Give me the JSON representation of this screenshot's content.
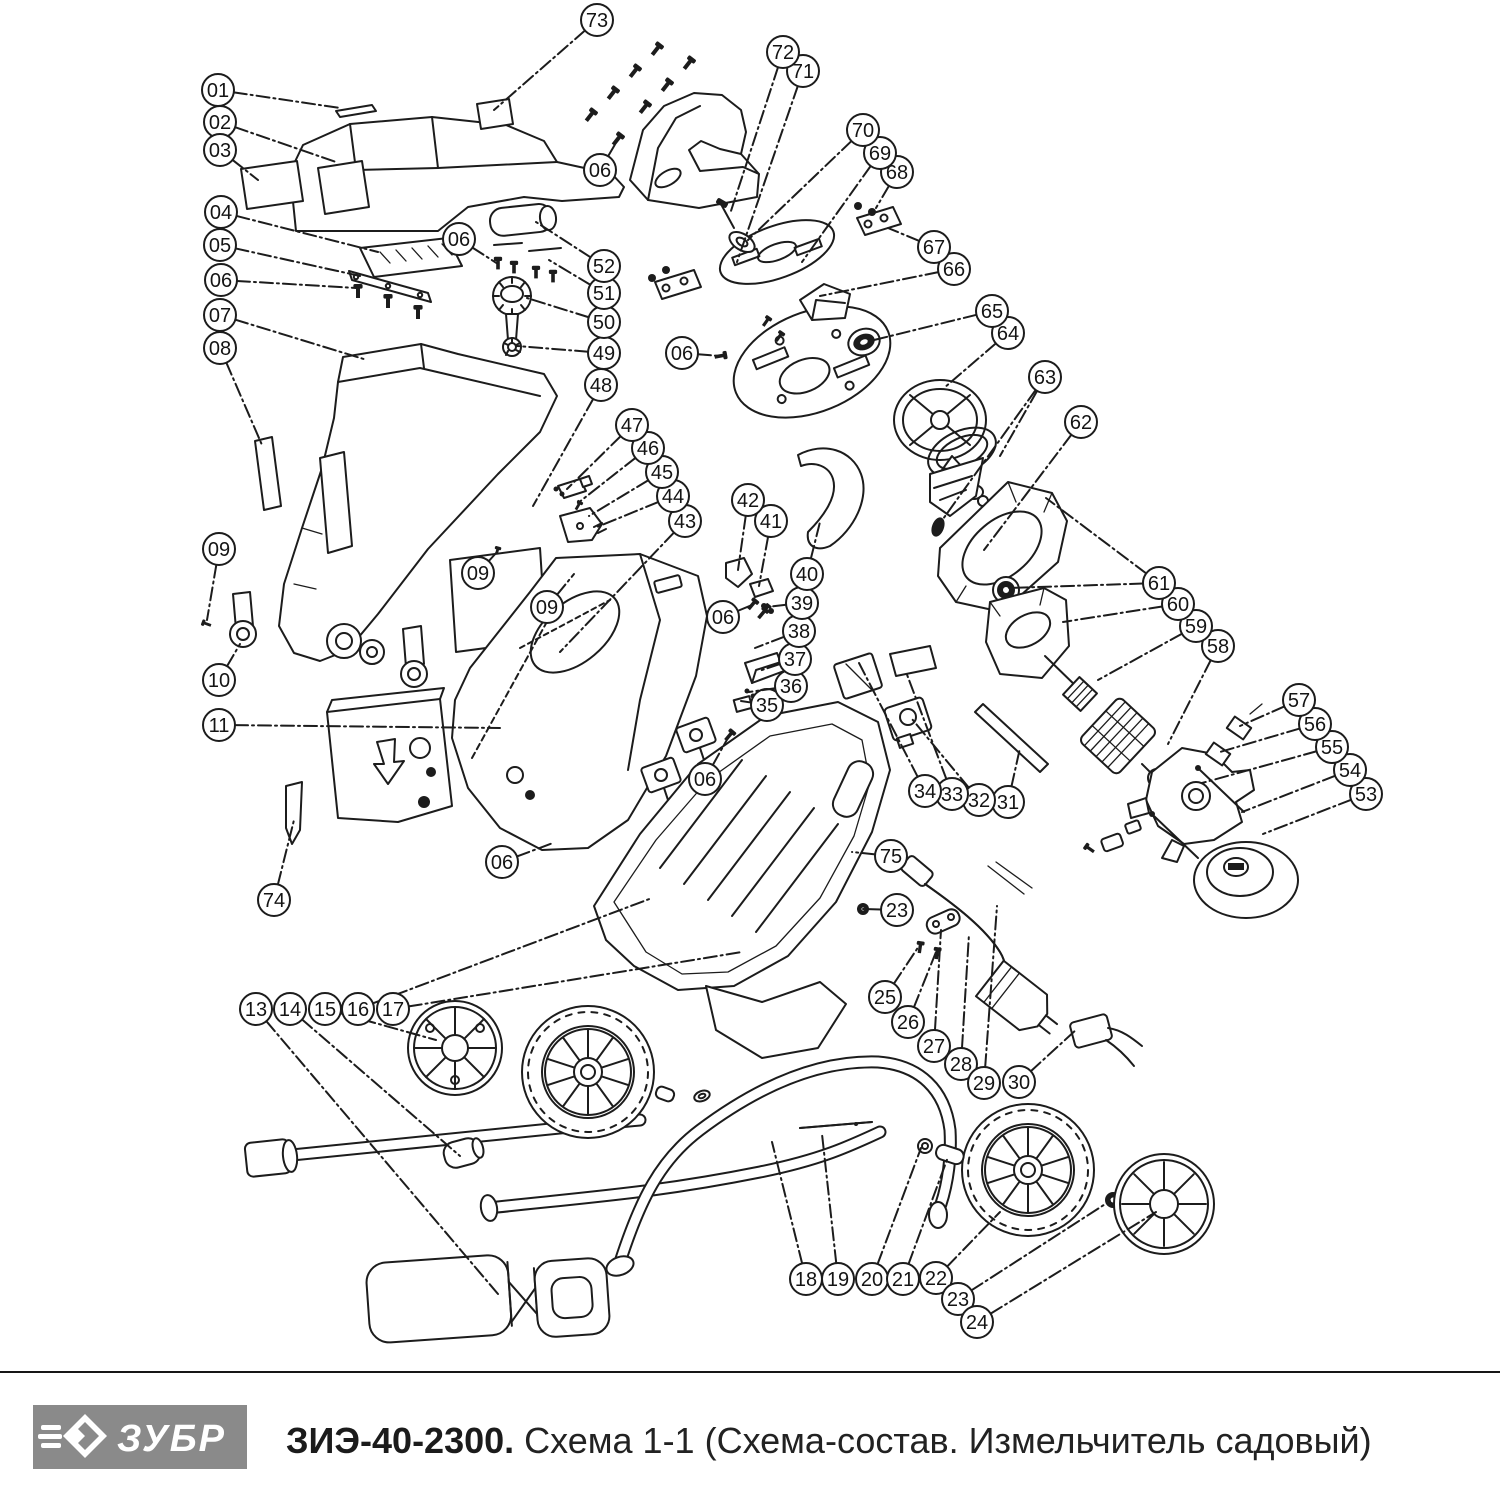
{
  "footer": {
    "brand": "ЗУБР",
    "model": "ЗИЭ-40-2300.",
    "subtitle": " Схема 1-1 (Схема-состав. Измельчитель садовый)",
    "logo_bg": "#8a8a8a",
    "logo_text_color": "#ffffff"
  },
  "diagram": {
    "line_color": "#1c1c1c",
    "callout_radius": 16,
    "callouts": [
      {
        "label": "01",
        "x": 218,
        "y": 90,
        "leaders": [
          [
            340,
            108
          ]
        ]
      },
      {
        "label": "02",
        "x": 220,
        "y": 122,
        "leaders": [
          [
            336,
            162
          ]
        ]
      },
      {
        "label": "03",
        "x": 220,
        "y": 150,
        "leaders": [
          [
            258,
            180
          ]
        ]
      },
      {
        "label": "04",
        "x": 221,
        "y": 212,
        "leaders": [
          [
            378,
            252
          ]
        ]
      },
      {
        "label": "05",
        "x": 220,
        "y": 245,
        "leaders": [
          [
            360,
            276
          ]
        ]
      },
      {
        "label": "06",
        "x": 221,
        "y": 280,
        "leaders": [
          [
            356,
            288
          ]
        ]
      },
      {
        "label": "07",
        "x": 220,
        "y": 315,
        "leaders": [
          [
            367,
            360
          ]
        ]
      },
      {
        "label": "08",
        "x": 220,
        "y": 348,
        "leaders": [
          [
            262,
            445
          ]
        ]
      },
      {
        "label": "09",
        "x": 219,
        "y": 549,
        "leaders": [
          [
            207,
            620
          ]
        ]
      },
      {
        "label": "10",
        "x": 219,
        "y": 680,
        "leaders": [
          [
            240,
            644
          ]
        ]
      },
      {
        "label": "11",
        "x": 219,
        "y": 725,
        "leaders": [
          [
            500,
            728
          ]
        ]
      },
      {
        "label": "74",
        "x": 274,
        "y": 900,
        "leaders": [
          [
            294,
            820
          ]
        ]
      },
      {
        "label": "13",
        "x": 256,
        "y": 1009,
        "leaders": [
          [
            498,
            1294
          ]
        ]
      },
      {
        "label": "14",
        "x": 290,
        "y": 1009,
        "leaders": [
          [
            460,
            1156
          ]
        ]
      },
      {
        "label": "15",
        "x": 325,
        "y": 1009,
        "leaders": [
          [
            436,
            1040
          ]
        ]
      },
      {
        "label": "16",
        "x": 358,
        "y": 1009,
        "leaders": [
          [
            652,
            898
          ]
        ]
      },
      {
        "label": "17",
        "x": 393,
        "y": 1009,
        "leaders": [
          [
            742,
            952
          ]
        ]
      },
      {
        "label": "18",
        "x": 806,
        "y": 1279,
        "leaders": [
          [
            772,
            1142
          ]
        ]
      },
      {
        "label": "19",
        "x": 838,
        "y": 1279,
        "leaders": [
          [
            822,
            1134
          ]
        ]
      },
      {
        "label": "20",
        "x": 872,
        "y": 1279,
        "leaders": [
          [
            921,
            1148
          ]
        ]
      },
      {
        "label": "21",
        "x": 903,
        "y": 1279,
        "leaders": [
          [
            948,
            1157
          ]
        ]
      },
      {
        "label": "22",
        "x": 936,
        "y": 1278,
        "leaders": [
          [
            1000,
            1212
          ]
        ]
      },
      {
        "label": "23",
        "x": 958,
        "y": 1299,
        "leaders": [
          [
            1110,
            1201
          ]
        ]
      },
      {
        "label": "24",
        "x": 977,
        "y": 1322,
        "leaders": [
          [
            1156,
            1212
          ]
        ]
      },
      {
        "label": "25",
        "x": 885,
        "y": 997,
        "leaders": [
          [
            919,
            946
          ]
        ]
      },
      {
        "label": "26",
        "x": 908,
        "y": 1022,
        "leaders": [
          [
            936,
            952
          ]
        ]
      },
      {
        "label": "27",
        "x": 934,
        "y": 1046,
        "leaders": [
          [
            941,
            930
          ]
        ]
      },
      {
        "label": "28",
        "x": 961,
        "y": 1064,
        "leaders": [
          [
            969,
            934
          ]
        ]
      },
      {
        "label": "29",
        "x": 984,
        "y": 1083,
        "leaders": [
          [
            997,
            906
          ]
        ]
      },
      {
        "label": "30",
        "x": 1019,
        "y": 1082,
        "leaders": [
          [
            1077,
            1029
          ]
        ]
      },
      {
        "label": "31",
        "x": 1008,
        "y": 802,
        "leaders": [
          [
            1020,
            748
          ]
        ]
      },
      {
        "label": "32",
        "x": 979,
        "y": 800,
        "leaders": [
          [
            912,
            719
          ]
        ]
      },
      {
        "label": "33",
        "x": 952,
        "y": 794,
        "leaders": [
          [
            906,
            672
          ]
        ]
      },
      {
        "label": "34",
        "x": 925,
        "y": 791,
        "leaders": [
          [
            859,
            663
          ]
        ]
      },
      {
        "label": "35",
        "x": 767,
        "y": 705,
        "leaders": [
          [
            741,
            701
          ]
        ]
      },
      {
        "label": "36",
        "x": 791,
        "y": 686,
        "leaders": [
          [
            749,
            692
          ]
        ]
      },
      {
        "label": "37",
        "x": 795,
        "y": 659,
        "leaders": [
          [
            759,
            671
          ]
        ]
      },
      {
        "label": "38",
        "x": 799,
        "y": 631,
        "leaders": [
          [
            755,
            648
          ]
        ]
      },
      {
        "label": "39",
        "x": 802,
        "y": 603,
        "leaders": [
          [
            766,
            607
          ]
        ]
      },
      {
        "label": "40",
        "x": 807,
        "y": 574,
        "leaders": [
          [
            820,
            522
          ]
        ]
      },
      {
        "label": "41",
        "x": 771,
        "y": 521,
        "leaders": [
          [
            759,
            586
          ]
        ]
      },
      {
        "label": "42",
        "x": 748,
        "y": 500,
        "leaders": [
          [
            738,
            570
          ]
        ]
      },
      {
        "label": "43",
        "x": 685,
        "y": 521,
        "leaders": [
          [
            560,
            652
          ]
        ]
      },
      {
        "label": "44",
        "x": 673,
        "y": 496,
        "leaders": [
          [
            597,
            527
          ]
        ]
      },
      {
        "label": "45",
        "x": 662,
        "y": 472,
        "leaders": [
          [
            589,
            516
          ]
        ]
      },
      {
        "label": "46",
        "x": 648,
        "y": 448,
        "leaders": [
          [
            578,
            503
          ]
        ]
      },
      {
        "label": "47",
        "x": 632,
        "y": 425,
        "leaders": [
          [
            567,
            489
          ]
        ]
      },
      {
        "label": "48",
        "x": 601,
        "y": 385,
        "leaders": [
          [
            533,
            506
          ]
        ]
      },
      {
        "label": "49",
        "x": 604,
        "y": 353,
        "leaders": [
          [
            517,
            346
          ]
        ]
      },
      {
        "label": "50",
        "x": 604,
        "y": 322,
        "leaders": [
          [
            527,
            298
          ]
        ]
      },
      {
        "label": "51",
        "x": 604,
        "y": 293,
        "leaders": [
          [
            549,
            260
          ]
        ]
      },
      {
        "label": "52",
        "x": 604,
        "y": 266,
        "leaders": [
          [
            536,
            222
          ]
        ]
      },
      {
        "label": "53",
        "x": 1366,
        "y": 794,
        "leaders": [
          [
            1263,
            834
          ]
        ]
      },
      {
        "label": "54",
        "x": 1350,
        "y": 770,
        "leaders": [
          [
            1242,
            812
          ]
        ]
      },
      {
        "label": "55",
        "x": 1332,
        "y": 747,
        "leaders": [
          [
            1202,
            783
          ]
        ]
      },
      {
        "label": "56",
        "x": 1315,
        "y": 724,
        "leaders": [
          [
            1220,
            752
          ]
        ]
      },
      {
        "label": "57",
        "x": 1299,
        "y": 700,
        "leaders": [
          [
            1240,
            726
          ]
        ]
      },
      {
        "label": "58",
        "x": 1218,
        "y": 646,
        "leaders": [
          [
            1168,
            744
          ]
        ]
      },
      {
        "label": "59",
        "x": 1196,
        "y": 626,
        "leaders": [
          [
            1098,
            680
          ]
        ]
      },
      {
        "label": "60",
        "x": 1178,
        "y": 604,
        "leaders": [
          [
            1063,
            622
          ]
        ]
      },
      {
        "label": "61",
        "x": 1159,
        "y": 583,
        "leaders": [
          [
            1046,
            498
          ],
          [
            1008,
            588
          ]
        ]
      },
      {
        "label": "62",
        "x": 1081,
        "y": 422,
        "leaders": [
          [
            984,
            550
          ]
        ]
      },
      {
        "label": "63",
        "x": 1045,
        "y": 377,
        "leaders": [
          [
            1000,
            456
          ],
          [
            938,
            526
          ]
        ]
      },
      {
        "label": "64",
        "x": 1008,
        "y": 333,
        "leaders": [
          [
            944,
            388
          ]
        ]
      },
      {
        "label": "65",
        "x": 992,
        "y": 311,
        "leaders": [
          [
            866,
            342
          ]
        ]
      },
      {
        "label": "66",
        "x": 954,
        "y": 269,
        "leaders": [
          [
            820,
            296
          ]
        ]
      },
      {
        "label": "67",
        "x": 934,
        "y": 247,
        "leaders": [
          [
            888,
            228
          ]
        ]
      },
      {
        "label": "68",
        "x": 897,
        "y": 172,
        "leaders": [
          [
            876,
            208
          ]
        ]
      },
      {
        "label": "69",
        "x": 880,
        "y": 153,
        "leaders": [
          [
            802,
            262
          ]
        ]
      },
      {
        "label": "70",
        "x": 863,
        "y": 130,
        "leaders": [
          [
            748,
            240
          ]
        ]
      },
      {
        "label": "71",
        "x": 803,
        "y": 71,
        "leaders": [
          [
            737,
            262
          ]
        ]
      },
      {
        "label": "72",
        "x": 783,
        "y": 52,
        "leaders": [
          [
            730,
            214
          ]
        ]
      },
      {
        "label": "73",
        "x": 597,
        "y": 20,
        "leaders": [
          [
            494,
            110
          ]
        ]
      },
      {
        "label": "75",
        "x": 891,
        "y": 856,
        "leaders": [
          [
            852,
            852
          ]
        ]
      },
      {
        "label": "06",
        "x": 459,
        "y": 239,
        "leaders": [
          [
            498,
            264
          ]
        ]
      },
      {
        "label": "06",
        "x": 600,
        "y": 170,
        "leaders": [
          [
            617,
            141
          ]
        ]
      },
      {
        "label": "06",
        "x": 682,
        "y": 353,
        "leaders": [
          [
            720,
            356
          ]
        ]
      },
      {
        "label": "06",
        "x": 723,
        "y": 617,
        "leaders": [
          [
            752,
            605
          ]
        ]
      },
      {
        "label": "06",
        "x": 705,
        "y": 779,
        "leaders": [
          [
            729,
            736
          ]
        ]
      },
      {
        "label": "06",
        "x": 502,
        "y": 862,
        "leaders": [
          [
            553,
            843
          ]
        ]
      },
      {
        "label": "09",
        "x": 478,
        "y": 573,
        "leaders": [
          [
            497,
            552
          ]
        ]
      },
      {
        "label": "09",
        "x": 547,
        "y": 607,
        "leaders": [
          [
            574,
            574
          ]
        ]
      },
      {
        "label": "23",
        "x": 897,
        "y": 910,
        "leaders": [
          [
            863,
            909
          ]
        ]
      }
    ]
  }
}
